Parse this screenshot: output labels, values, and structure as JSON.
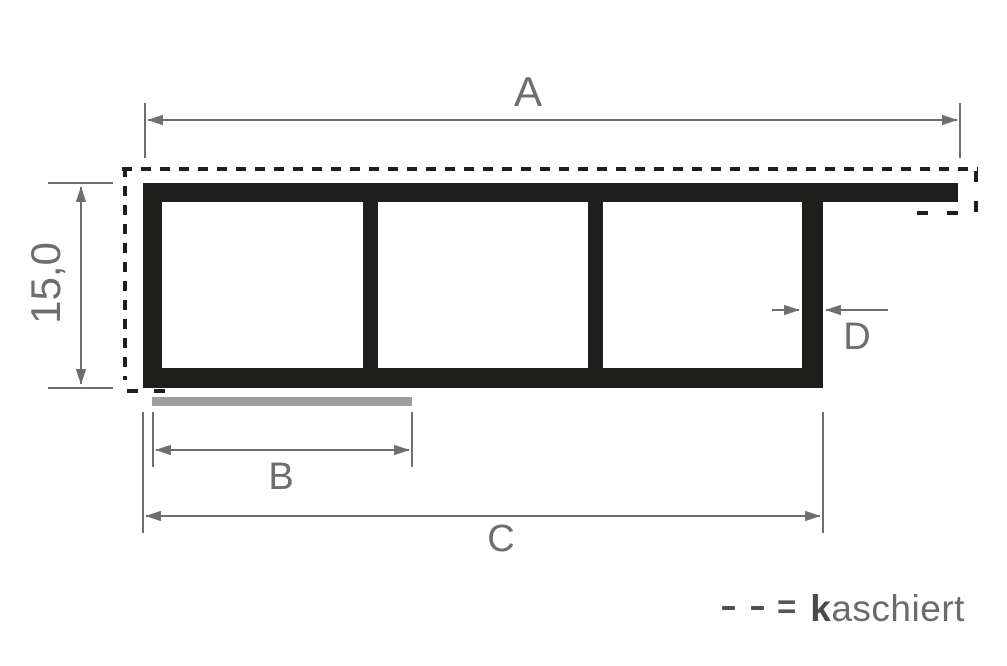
{
  "drawing_type": "profile-cross-section-dimension-drawing",
  "dimensions": {
    "a_label": "A",
    "height_label": "15,0",
    "b_label": "B",
    "c_label": "C",
    "d_label": "D"
  },
  "legend": {
    "symbol": "- -",
    "equals_sign": "=",
    "term_bold": "k",
    "term_rest": "aschiert"
  },
  "colors": {
    "profile": "#1e1e1c",
    "dashed_outline": "#1e1e1c",
    "dimension_lines": "#6e6e6e",
    "label_text": "#6e6e6e",
    "cover_strip": "#9d9d9c",
    "legend_symbol": "#4f4f4f",
    "background": "#ffffff"
  }
}
